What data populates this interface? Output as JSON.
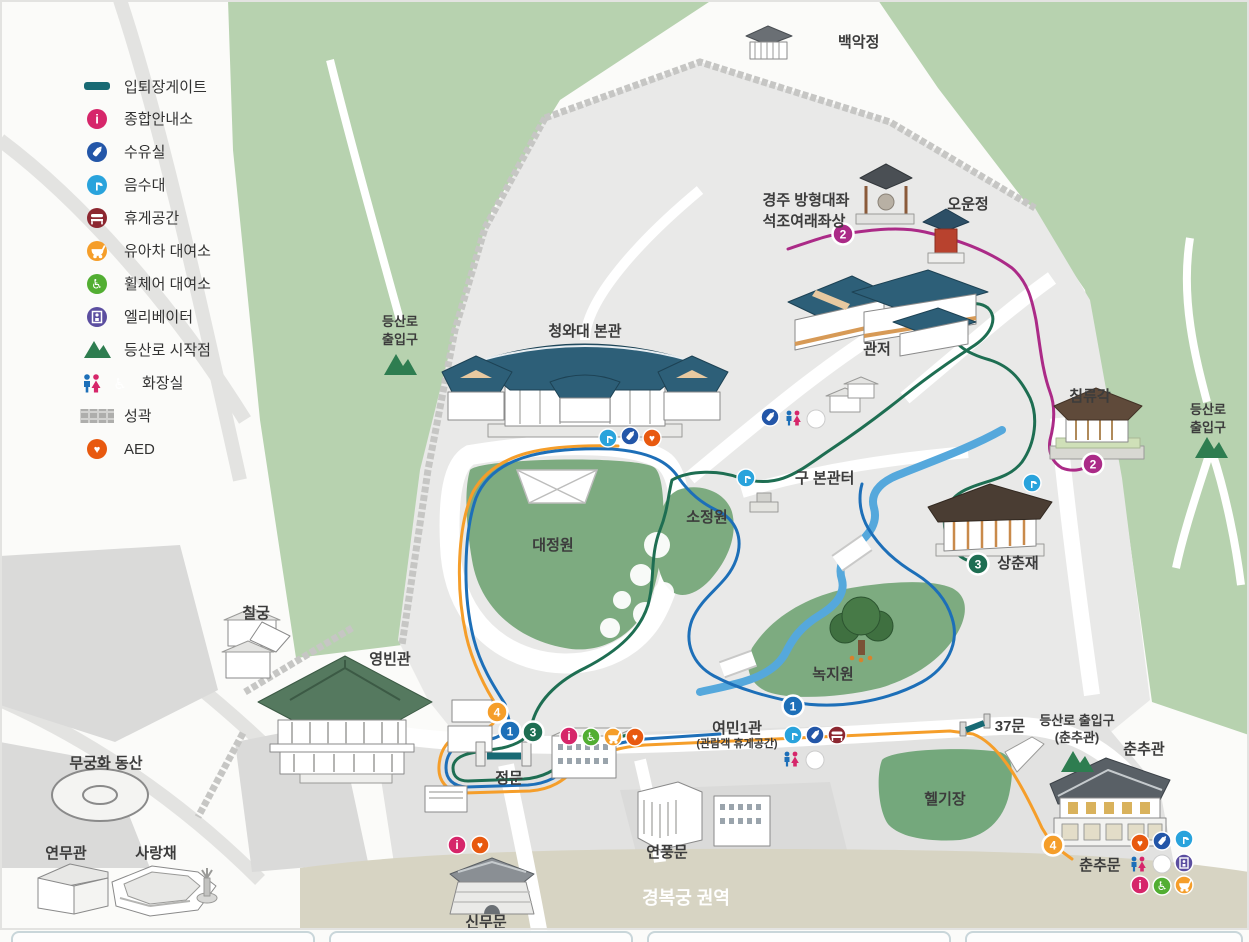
{
  "title": "청와대 안내도",
  "legend": {
    "items": [
      {
        "id": "entry-exit-gate",
        "label": "입퇴장게이트",
        "color": "#186a74",
        "type": "line"
      },
      {
        "id": "info-center",
        "label": "종합안내소",
        "color": "#d6266a"
      },
      {
        "id": "nursing-room",
        "label": "수유실",
        "color": "#2356a8"
      },
      {
        "id": "water-fountain",
        "label": "음수대",
        "color": "#29a3dc"
      },
      {
        "id": "rest-area",
        "label": "휴게공간",
        "color": "#8c2730"
      },
      {
        "id": "stroller-rental",
        "label": "유아차 대여소",
        "color": "#f59e2a"
      },
      {
        "id": "wheelchair-rental",
        "label": "휠체어 대여소",
        "color": "#52ae32"
      },
      {
        "id": "elevator",
        "label": "엘리베이터",
        "color": "#5b4ea0"
      },
      {
        "id": "trail-start",
        "label": "등산로 시작점",
        "color": "#2e7d50"
      },
      {
        "id": "toilet",
        "label": "화장실",
        "colors": [
          "#1d6fb8",
          "#d6266a",
          "#19a89c"
        ]
      },
      {
        "id": "fortress-wall",
        "label": "성곽",
        "color": "#bdbdbc"
      },
      {
        "id": "aed",
        "label": "AED",
        "color": "#e8590f"
      }
    ]
  },
  "places": {
    "baegakjeong": "백악정",
    "gyeongju_l1": "경주 방형대좌",
    "gyeongju_l2": "석조여래좌상",
    "ounjeong": "오운정",
    "bongwan": "청와대 본관",
    "gwanjeo": "관저",
    "chimnyugak": "침류각",
    "gubongwanteo": "구 본관터",
    "sojeongwon": "소정원",
    "daejeongwon": "대정원",
    "sangchunjae": "상춘재",
    "nokjiwon": "녹지원",
    "chilgung": "칠궁",
    "yeongbingwan": "영빈관",
    "mugunghwa": "무궁화 동산",
    "yeonmugwan": "연무관",
    "sarangchae": "사랑채",
    "jeongmun": "정문",
    "yeomin1": "여민1관",
    "yeomin1_sub": "(관람객 휴게공간)",
    "yeonpungmun": "연풍문",
    "sinmumun": "신무문",
    "helipad": "헬기장",
    "mun37": "37문",
    "chunchugwan": "춘추관",
    "chunchumun": "춘추문",
    "gyeongbokgung": "경복궁 권역"
  },
  "trail": {
    "line1": "등산로",
    "line2": "출입구",
    "combined": "등산로 출입구",
    "chunchu_sub": "(춘추관)"
  },
  "badges": {
    "b1": "1",
    "b2": "2",
    "b3": "3",
    "b4": "4"
  },
  "badge_colors": {
    "1": "#1d6fb8",
    "2": "#ab2a87",
    "3": "#1e6e52",
    "4": "#f59e2a"
  },
  "route_colors": {
    "blue": "#1d6fb8",
    "orange": "#f59e2a",
    "green": "#1e6e52",
    "magenta": "#ab2a87"
  },
  "map_colors": {
    "forest": "#b7d2af",
    "garden": "#7dab80",
    "interior": "#e9e9e8",
    "stream": "#55a8dc",
    "palace_zone": "#d7d4c3",
    "gate_bar": "#186a74"
  },
  "glyphs": {
    "info": "i",
    "aed": "♥",
    "wheelchair": "♿"
  }
}
